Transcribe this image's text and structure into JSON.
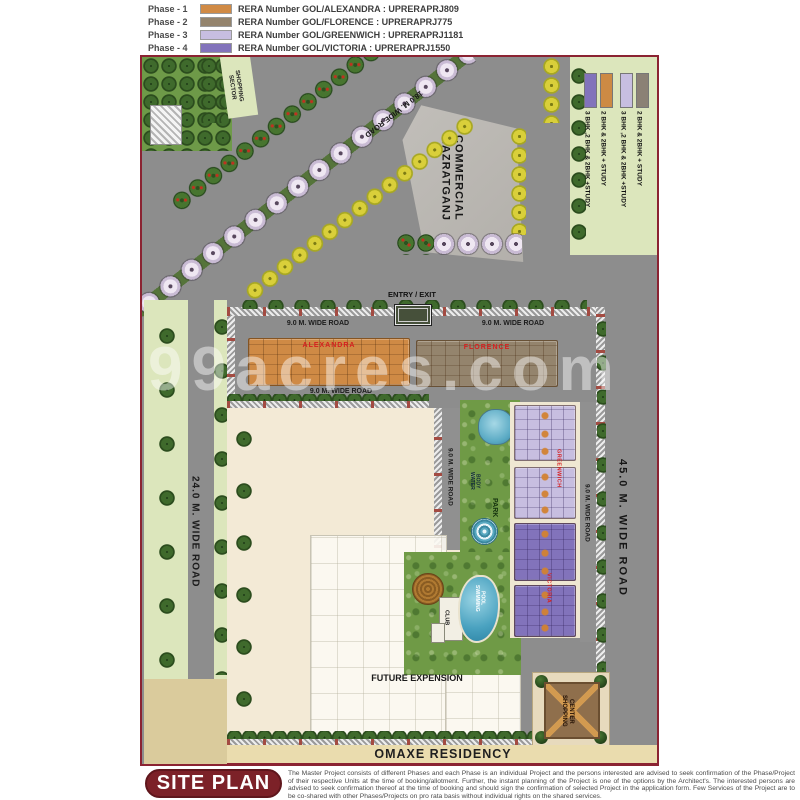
{
  "watermark": "99acres.com",
  "phase_legend": {
    "rows": [
      {
        "phase": "Phase - 1",
        "color": "#d08a45",
        "rera": "RERA Number GOL/ALEXANDRA : UPRERAPRJ809"
      },
      {
        "phase": "Phase - 2",
        "color": "#94846d",
        "rera": "RERA Number GOL/FLORENCE : UPRERAPRJ775"
      },
      {
        "phase": "Phase - 3",
        "color": "#c7bee0",
        "rera": "RERA Number GOL/GREENWICH : UPRERAPRJ1181"
      },
      {
        "phase": "Phase - 4",
        "color": "#8273bb",
        "rera": "RERA Number GOL/VICTORIA : UPRERAPRJ1550"
      }
    ]
  },
  "unit_legend": {
    "items": [
      {
        "color": "#8273bb",
        "label": "3 BHK ,2 BHK & 2BHK +STUDY"
      },
      {
        "color": "#cd8a44",
        "label": "2 BHK & 2BHK + STUDY"
      },
      {
        "color": "#c7bee0",
        "label": "3 BHK ,2 BHK & 2BHK +STUDY"
      },
      {
        "color": "#8b8175",
        "label": "2 BHK & 2BHK + STUDY"
      }
    ]
  },
  "map": {
    "labels": {
      "sector_shopping": "SECTOR SHOPPING",
      "commercial": "HAZRATGANJ COMMERCIAL",
      "entry_exit": "ENTRY / EXIT",
      "road_18": "18.0 M. WIDE ROAD",
      "road_24": "24.0 M. WIDE ROAD",
      "road_45": "45.0 M. WIDE ROAD",
      "road_9": "9.0 M. WIDE ROAD",
      "alexandra": "ALEXANDRA",
      "florence": "FLORENCE",
      "greenwich": "GREENWICH",
      "victoria": "VICTORIA",
      "park": "PARK",
      "water_body": "WATER BODY",
      "club": "CLUB",
      "swimming_pool": "SWIMMING POOL",
      "future_expension": "FUTURE EXPENSION",
      "shopping_center": "SHOPPING CENTER",
      "project": "OMAXE RESIDENCY"
    }
  },
  "footer": {
    "badge": "SITE PLAN",
    "disclaimer": "The Master Project consists of different Phases and each Phase is an individual Project and the persons interested are advised to seek confirmation of the Phase/Project of their respective Units at the time of booking/allotment. Further, the instant planning of the Project is one of the options by the Architect's. The interested persons are advised to seek confirmation thereof at the time of booking and should sign the confirmation of selected Project in the application form. Few Services of the Project are to be co-shared with other Phases/Projects on pro rata basis without individual rights on the shared services."
  }
}
